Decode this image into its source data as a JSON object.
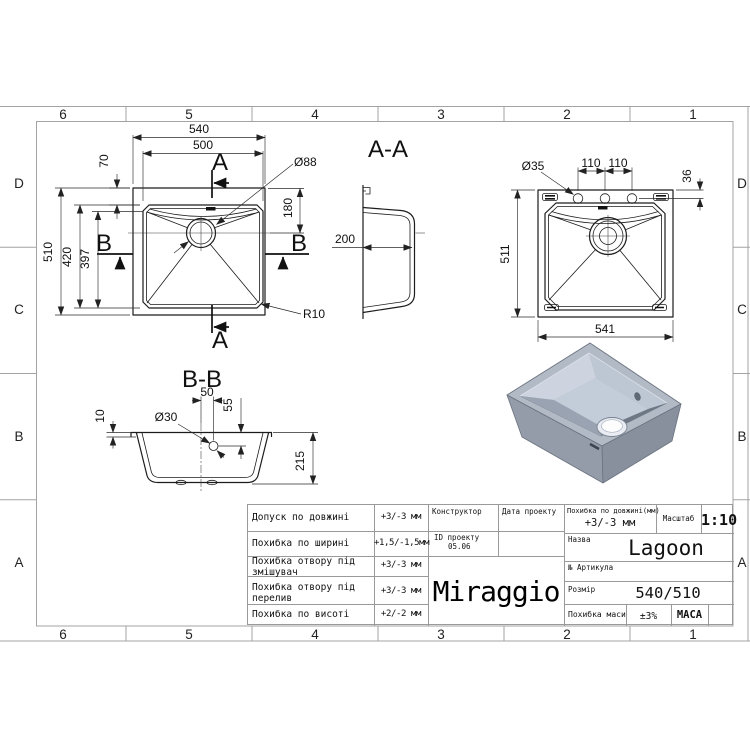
{
  "zones": {
    "cols": [
      "6",
      "5",
      "4",
      "3",
      "2",
      "1"
    ],
    "rows": [
      "D",
      "C",
      "B",
      "A"
    ]
  },
  "views": {
    "plan": {
      "d540": "540",
      "d500": "500",
      "d70": "70",
      "d88": "Ø88",
      "d180": "180",
      "d510": "510",
      "d420": "420",
      "d397": "397",
      "r10": "R10",
      "marker_a": "A",
      "marker_b": "B"
    },
    "section_aa": {
      "title": "A-A",
      "d200": "200"
    },
    "bottom": {
      "d35": "Ø35",
      "d110a": "110",
      "d110b": "110",
      "d36": "36",
      "d511": "511",
      "d541": "541"
    },
    "section_bb": {
      "title": "B-B",
      "d50": "50",
      "d55": "55",
      "d30": "Ø30",
      "d10": "10",
      "d215": "215"
    }
  },
  "title_block": {
    "tolerances": [
      {
        "label": "Допуск по довжині",
        "value": "+3/-3 мм"
      },
      {
        "label": "Похибка по ширині",
        "value": "+1,5/-1,5мм"
      },
      {
        "label": "Похибка отвору під змішувач",
        "value": "+3/-3 мм"
      },
      {
        "label": "Похибка отвору під перелив",
        "value": "+3/-3 мм"
      },
      {
        "label": "Похибка по висоті",
        "value": "+2/-2 мм"
      }
    ],
    "constructor_label": "Конструктор",
    "date_label": "Дата проекту",
    "project_id_label": "ID проекту",
    "project_id_value": "05.06",
    "length_tol_label": "Похибка по довжині(мм)",
    "length_tol_value": "+3/-3 мм",
    "scale_label": "Масштаб",
    "scale_value": "1:10",
    "name_label": "Назва",
    "name_value": "Lagoon",
    "article_label": "№ Артикула",
    "size_label": "Розмір",
    "size_value": "540/510",
    "mass_tol_label": "Похибка маси",
    "mass_tol_value": "±3%",
    "mass_label": "МАСА",
    "logo": "Miraggio"
  },
  "colors": {
    "line": "#1c1c1c",
    "frame": "#a3a3a3",
    "sink_top": "#b2bac6",
    "sink_side": "#939ca8",
    "sink_inner_dark": "#6e7785"
  }
}
